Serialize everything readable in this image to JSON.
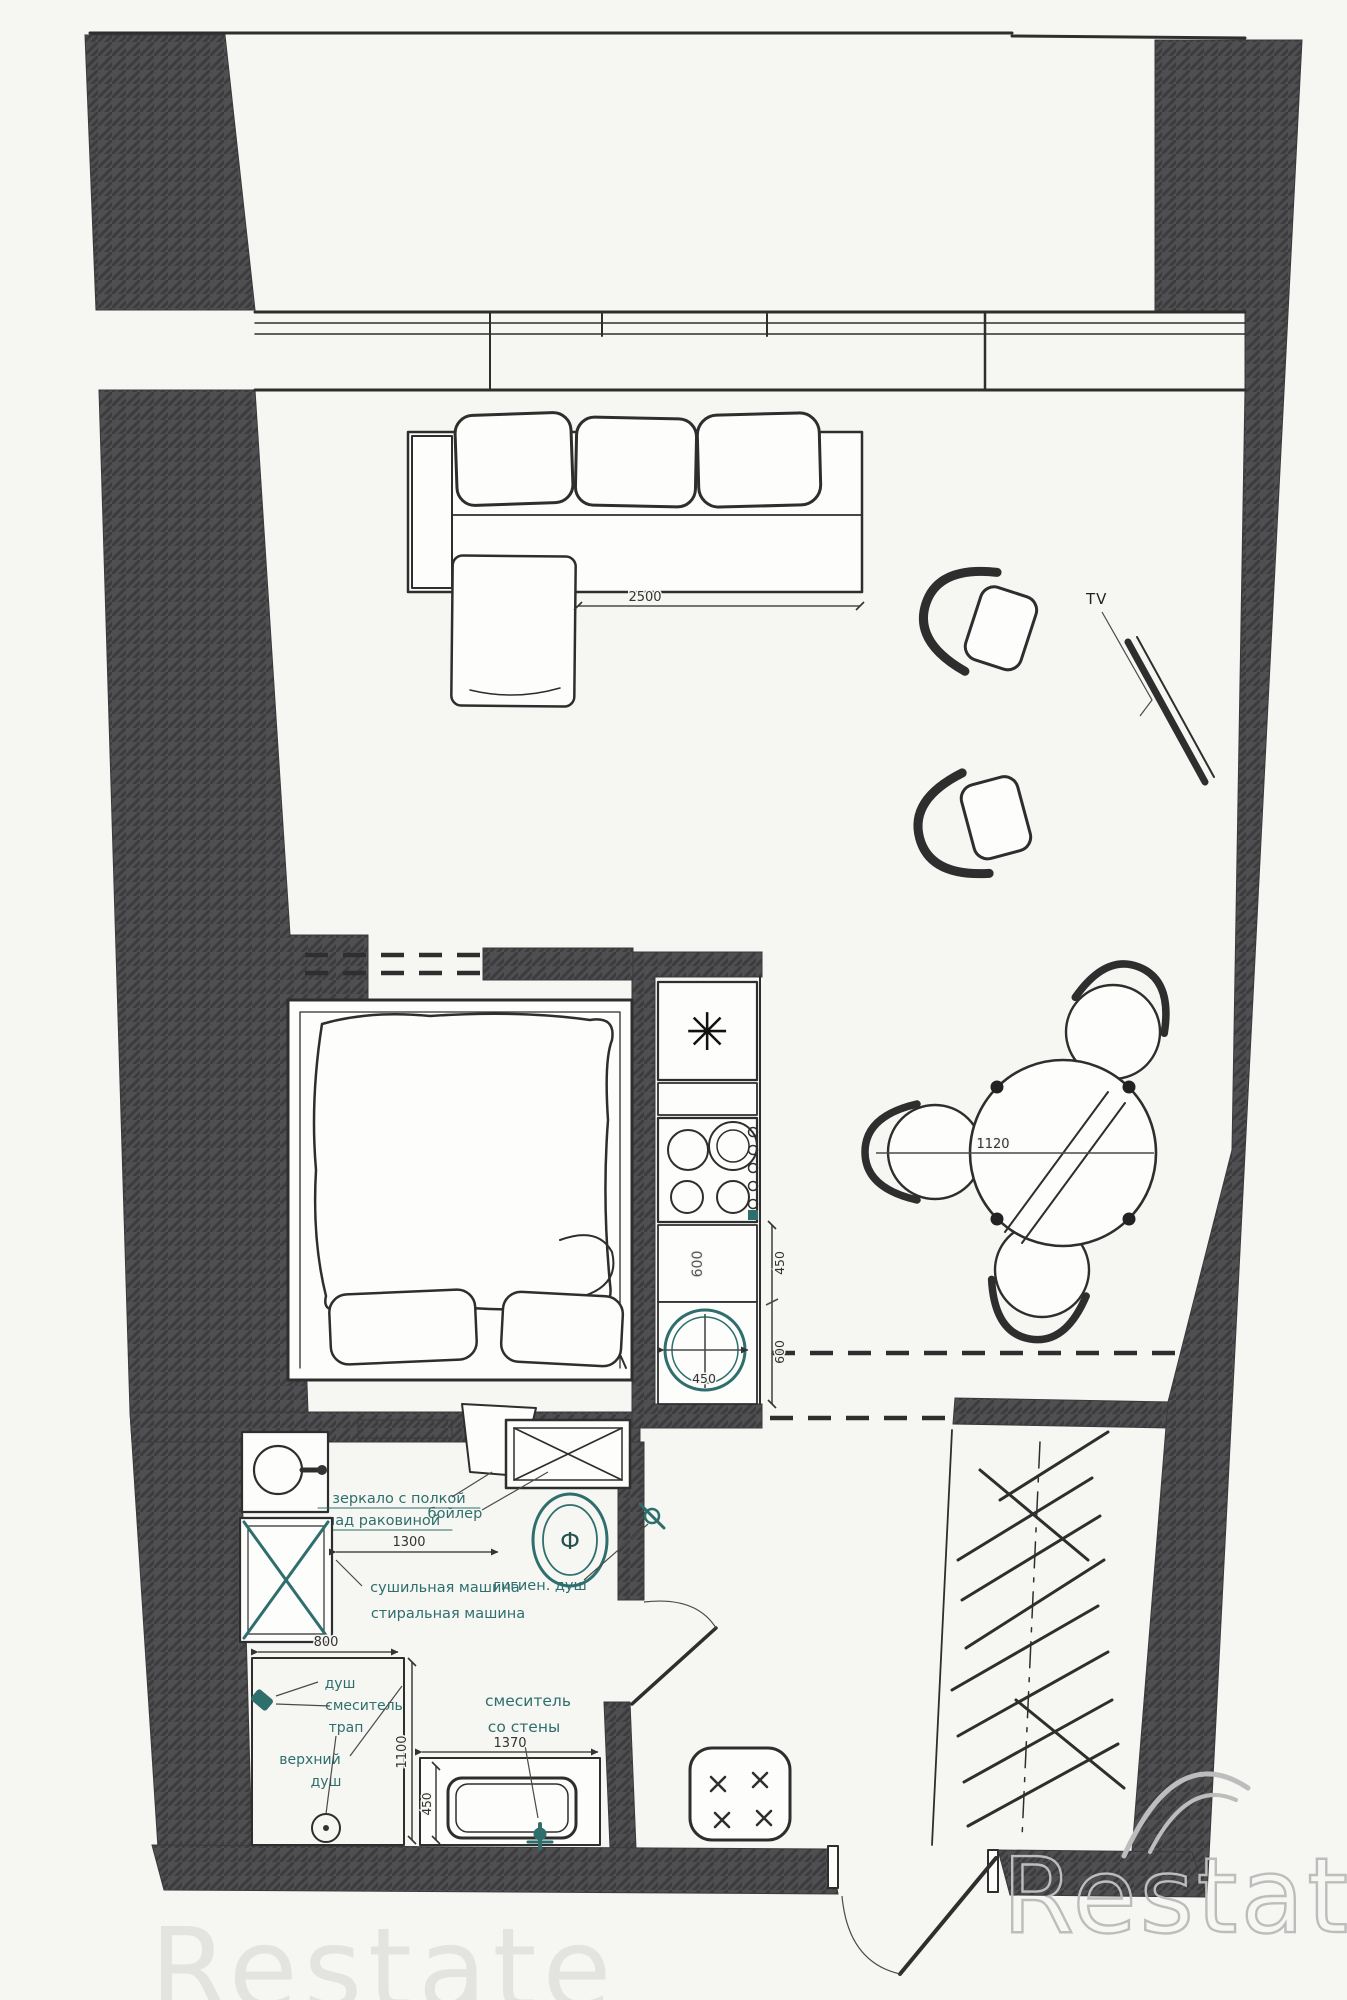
{
  "plan": {
    "colors": {
      "paper": "#f6f6f3",
      "wall": "#4f4f51",
      "line": "#2e2e2e",
      "teal": "#2e6f6d",
      "watermark": "#bdbdbd"
    },
    "labels": {
      "tv": "TV",
      "freezer_star": "✳",
      "boiler": "бойлер",
      "dryer_machine": "сушильная машина",
      "washing_machine": "стиральная машина",
      "hygienic_shower": "гигиен. душ",
      "shower": "душ",
      "shower_mixer": "смеситель",
      "shower_drain": "трап",
      "overhead_shower_line1": "верхний",
      "overhead_shower_line2": "душ",
      "wall_mixer_line1": "смеситель",
      "wall_mixer_line2": "со стены",
      "bath_note_line1": "зеркало с полкой",
      "bath_note_line2": "над раковиной",
      "toilet_mark": "Ф"
    },
    "dims": {
      "sofa_width": "2500",
      "table_diameter": "1120",
      "kitchen_sink": "450",
      "kitchen_counter_vertical": "600",
      "kitchen_depth_top": "450",
      "kitchen_depth_bottom": "600",
      "washer_to_wall": "1300",
      "shower_width": "800",
      "shower_depth": "1100",
      "vanity_width": "1370",
      "vanity_depth": "450"
    },
    "watermark": {
      "main": "Restate",
      "echo": "Restate"
    }
  }
}
